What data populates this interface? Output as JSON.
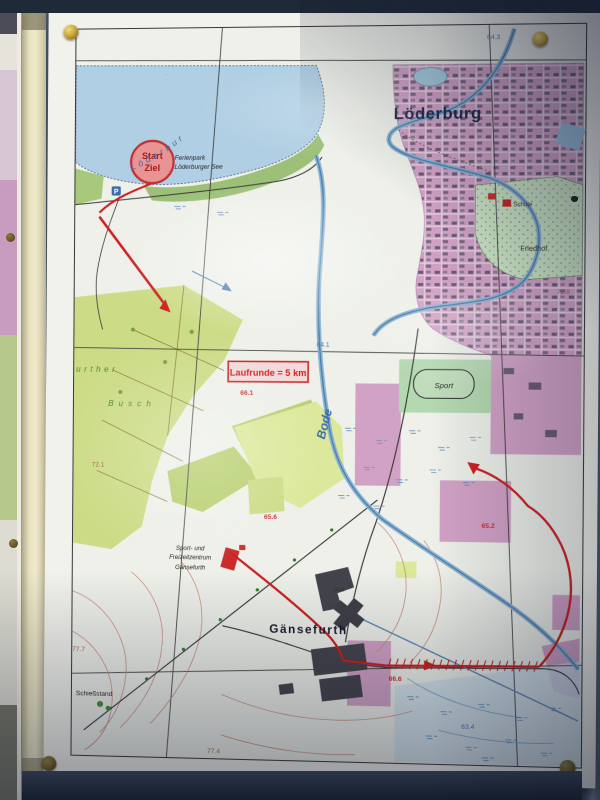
{
  "map": {
    "labels": {
      "town_main": "Löderburg",
      "town_south": "Gänsefurth",
      "start": "Start",
      "ziel": "Ziel",
      "ferienpark_line1": "Ferienpark",
      "ferienpark_line2": "Löderburger See",
      "route_banner": "Laufrunde = 5 km",
      "river": "Bode",
      "lake": "Löderbur",
      "forest_line1": "urther",
      "forest_line2": "Busch",
      "sport": "Sport",
      "freizeit_line1": "Sport- und",
      "freizeit_line2": "Freizeitzentrum",
      "freizeit_line3": "Gänsefurth",
      "cemetery": "Friedhof",
      "school": "Schule",
      "stable": "Stall",
      "shooting_range": "Schießstand",
      "parking": "P"
    },
    "spot_heights": {
      "h64_3": "64.3",
      "h72_8": "72.8",
      "h64_1": "64.1",
      "h66_1": "66.1",
      "h72_1": "72.1",
      "h65_6": "65.6",
      "h65_2": "65.2",
      "h66_6": "66.6",
      "h63_4": "63.4",
      "h77_7": "77.7",
      "h77_4": "77.4"
    },
    "colors": {
      "route_red": "#cc2020",
      "water_blue": "#4a7ab5",
      "town_pink": "#d2a2c6",
      "forest_green": "#ccdc86",
      "lake_blue": "#b0cfe4",
      "board_blue": "#46586c",
      "frame_cream": "#e8e2c0",
      "pin_brass": "#c8a838"
    }
  }
}
